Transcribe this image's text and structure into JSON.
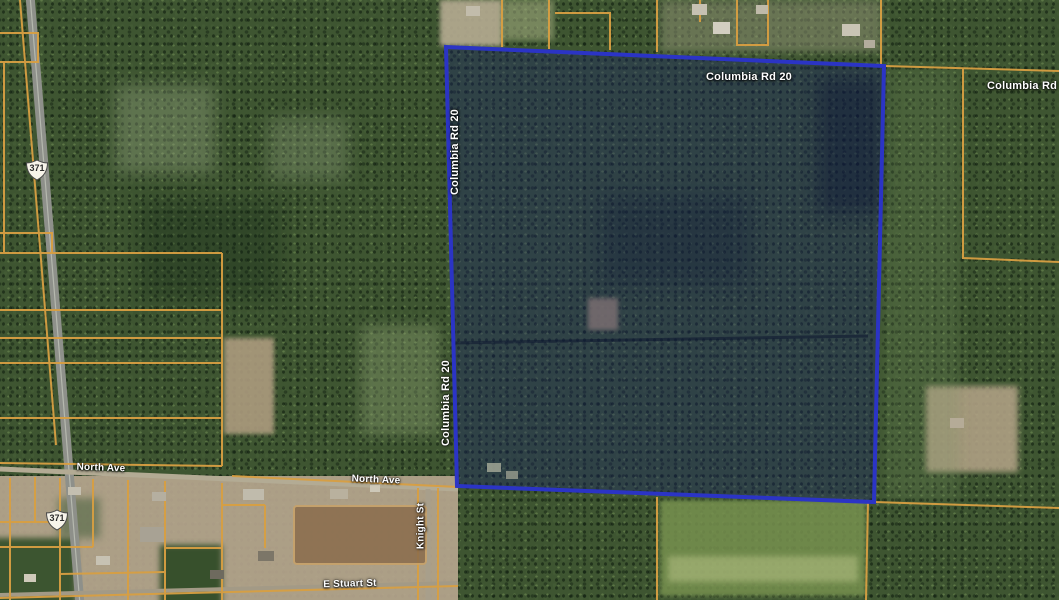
{
  "map": {
    "description": "satellite-parcel-map",
    "labels": {
      "columbia_rd_top": "Columbia Rd 20",
      "columbia_rd_right": "Columbia Rd 20",
      "columbia_rd_left_upper": "Columbia Rd 20",
      "columbia_rd_left_lower": "Columbia Rd 20",
      "north_ave_west": "North Ave",
      "north_ave_east": "North Ave",
      "knight_st": "Knight St",
      "e_stuart_st": "E Stuart St",
      "highway_371_north": "371",
      "highway_371_south": "371"
    },
    "colors": {
      "parcel_line": "#d89f42",
      "selected_parcel_stroke": "#2b34c5",
      "selected_parcel_fill": "rgba(20,30,110,0.34)",
      "road_fill": "#8e908a",
      "label_text": "#ffffff"
    }
  }
}
